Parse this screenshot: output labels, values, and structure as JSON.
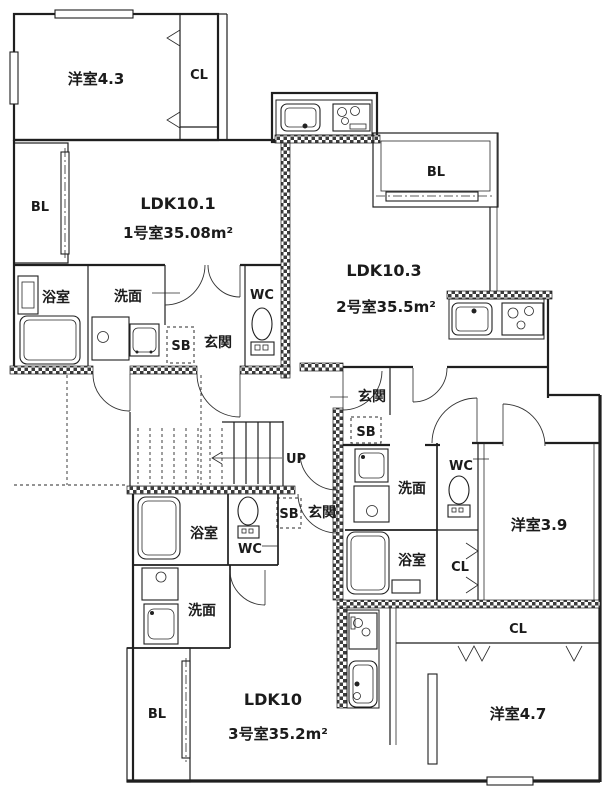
{
  "plan": {
    "title": "apartment-floor-plan",
    "colors": {
      "line": "#1f1f1f",
      "background": "#ffffff"
    },
    "units": [
      {
        "id": "unit1",
        "ldk_label": "LDK10.1",
        "area_label": "1号室35.08m²",
        "rooms": {
          "western_room": "洋室4.3",
          "closet": "CL",
          "balcony": "BL",
          "bath": "浴室",
          "washroom": "洗面",
          "toilet": "WC",
          "shoe_box": "SB",
          "entrance": "玄関"
        }
      },
      {
        "id": "unit2",
        "ldk_label": "LDK10.3",
        "area_label": "2号室35.5m²",
        "rooms": {
          "western_room": "洋室3.9",
          "closet": "CL",
          "balcony": "BL",
          "bath": "浴室",
          "washroom": "洗面",
          "toilet": "WC",
          "shoe_box": "SB",
          "entrance": "玄関"
        }
      },
      {
        "id": "unit3",
        "ldk_label": "LDK10",
        "area_label": "3号室35.2m²",
        "rooms": {
          "western_room": "洋室4.7",
          "closet": "CL",
          "balcony": "BL",
          "bath": "浴室",
          "washroom": "洗面",
          "toilet": "WC",
          "shoe_box": "SB",
          "entrance": "玄関"
        }
      }
    ],
    "stairs": {
      "direction_label": "UP"
    }
  }
}
